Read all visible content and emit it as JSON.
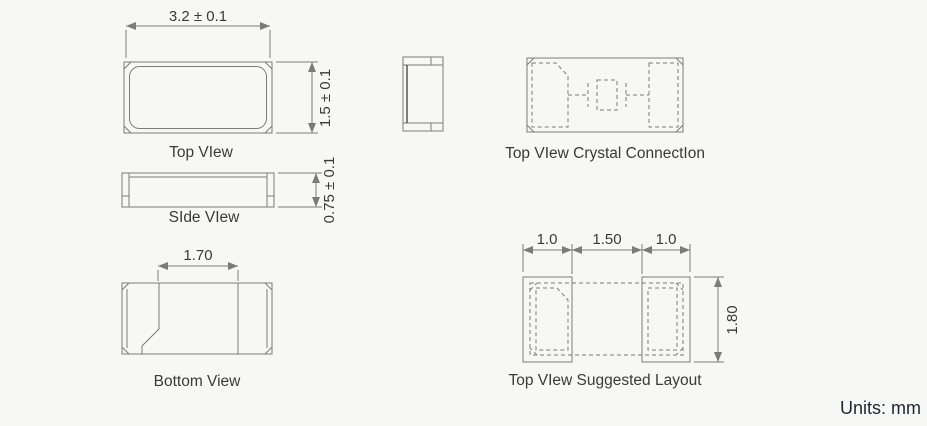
{
  "colors": {
    "background": "#f7f7f6",
    "line": "#7b7b7b",
    "dark_line": "#4a4a4a",
    "text": "#3a3a3a",
    "units_text": "#222833"
  },
  "views": {
    "top_view": {
      "label": "Top VIew",
      "width_dim": "3.2 ± 0.1",
      "height_dim": "1.5 ± 0.1"
    },
    "side_view": {
      "label": "SIde VIew",
      "thickness_dim": "0.75 ± 0.1"
    },
    "bottom_view": {
      "label": "Bottom View",
      "pad_gap_dim": "1.70"
    },
    "crystal_connection": {
      "label": "Top VIew Crystal ConnectIon"
    },
    "suggested_layout": {
      "label": "Top VIew Suggested Layout",
      "left_pad_width_dim": "1.0",
      "pad_gap_dim": "1.50",
      "right_pad_width_dim": "1.0",
      "pad_height_dim": "1.80"
    }
  },
  "footer": {
    "units_label": "Units: mm"
  }
}
